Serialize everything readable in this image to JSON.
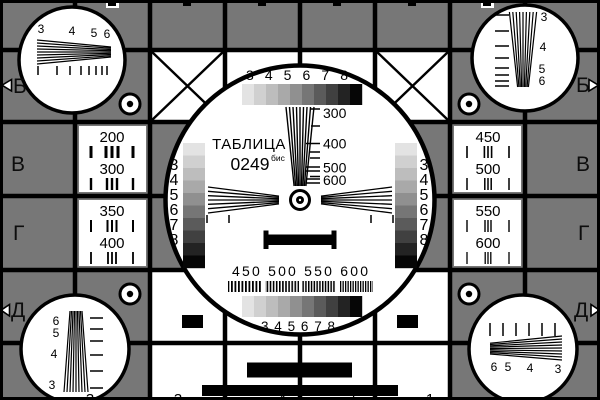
{
  "colors": {
    "background": "#777777",
    "ink": "#000000",
    "white": "#ffffff"
  },
  "center": {
    "title": "ТАБЛИЦА",
    "code": "0249",
    "code_suffix": "бис",
    "top_scale": "3 4 5 6 7 8",
    "bottom_scale": "3 4 5 6 7 8",
    "bottom_freq_scale": "450 500 550 600",
    "wedge_labels": [
      "300",
      "400",
      "500",
      "600"
    ],
    "left_column_digits": [
      "3",
      "4",
      "5",
      "6",
      "7",
      "8"
    ],
    "right_column_digits": [
      "3",
      "4",
      "5",
      "6",
      "7",
      "8"
    ]
  },
  "side_panels": {
    "left_top": [
      "200",
      "300"
    ],
    "left_bottom": [
      "350",
      "400"
    ],
    "right_top": [
      "450",
      "500"
    ],
    "right_bottom": [
      "550",
      "600"
    ]
  },
  "corner_circles": {
    "top_left": [
      "3",
      "4",
      "5",
      "6"
    ],
    "top_right": [
      "3",
      "4",
      "5",
      "6"
    ],
    "bottom_left": [
      "6",
      "5",
      "4",
      "3"
    ],
    "bottom_right": [
      "6",
      "5",
      "4",
      "3"
    ]
  },
  "edge_letters": {
    "left": [
      "Б",
      "В",
      "Г",
      "Д"
    ],
    "right": [
      "Б",
      "В",
      "Г",
      "Д"
    ]
  },
  "bottom_edge_digits": [
    "3",
    "3",
    "4",
    "5",
    "1"
  ],
  "grayscale_steps": [
    "#e3e3e3",
    "#d0d0d0",
    "#bdbdbd",
    "#a9a9a9",
    "#909090",
    "#767676",
    "#5b5b5b",
    "#404040",
    "#232323",
    "#060606"
  ]
}
